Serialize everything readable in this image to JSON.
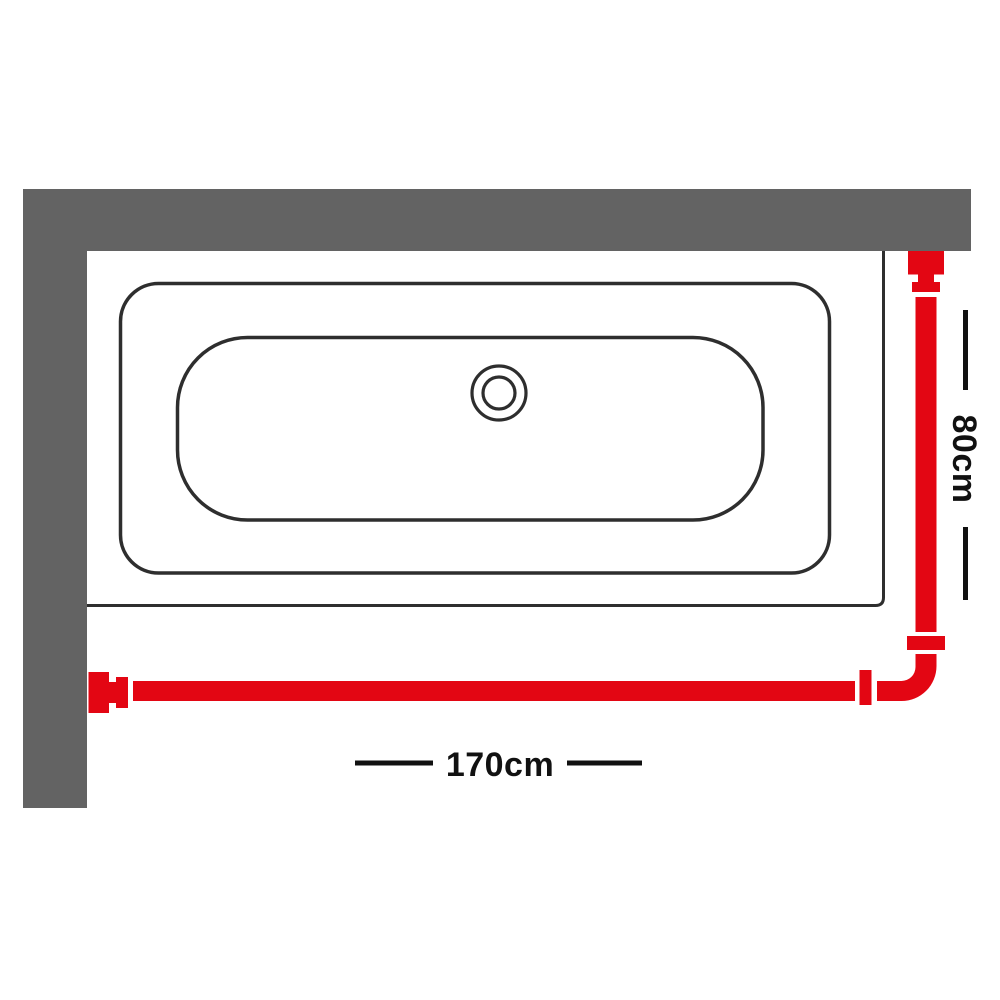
{
  "diagram": {
    "name": "shower-curtain-rail-bath-top-view",
    "dimensions": {
      "width_label": "170cm",
      "depth_label": "80cm"
    },
    "colors": {
      "rail_red": "#e30613",
      "wall_gray": "#636363",
      "outline_dark": "#2e2e2e",
      "label_dark": "#111111",
      "background": "#ffffff"
    }
  }
}
